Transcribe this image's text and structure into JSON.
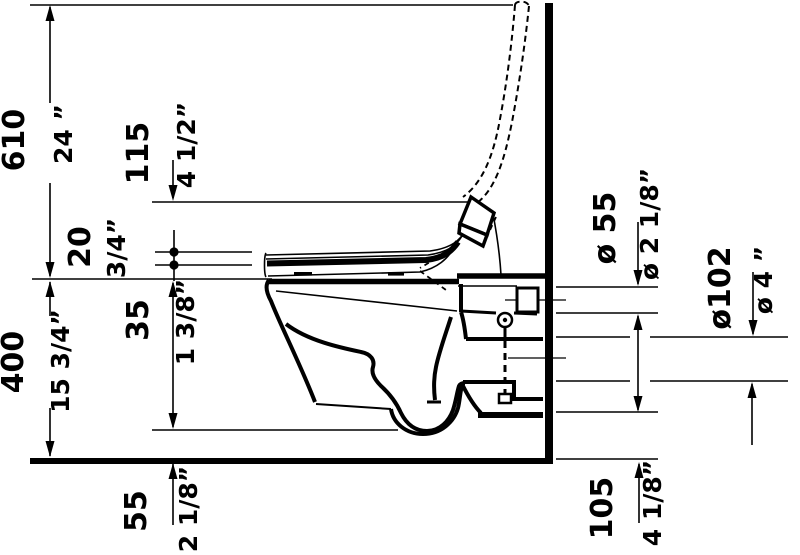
{
  "drawing": {
    "kind": "wall-hung toilet with seat — side elevation, dimensioned",
    "colors": {
      "ink": "#000000",
      "background": "#ffffff"
    }
  },
  "dims": {
    "total_height": {
      "mm": "610",
      "inch": "24 ”"
    },
    "lid_top_offset": {
      "mm": "115",
      "inch": "4 1/2”"
    },
    "seat_stack": {
      "mm": "20",
      "inch": "3/4”"
    },
    "seat_height": {
      "mm": "35",
      "inch": "1 3/8”"
    },
    "rim_height": {
      "mm": "400",
      "inch": "15 3/4”"
    },
    "front_underside": {
      "mm": "55",
      "inch": "2 1/8”"
    },
    "supply_diameter": {
      "mm": "ø 55",
      "inch": "ø 2 1/8”"
    },
    "drain_diameter": {
      "mm": "ø102",
      "inch": "ø 4 ”"
    },
    "outlet_clearance": {
      "mm": "105",
      "inch": "4 1/8”"
    }
  }
}
